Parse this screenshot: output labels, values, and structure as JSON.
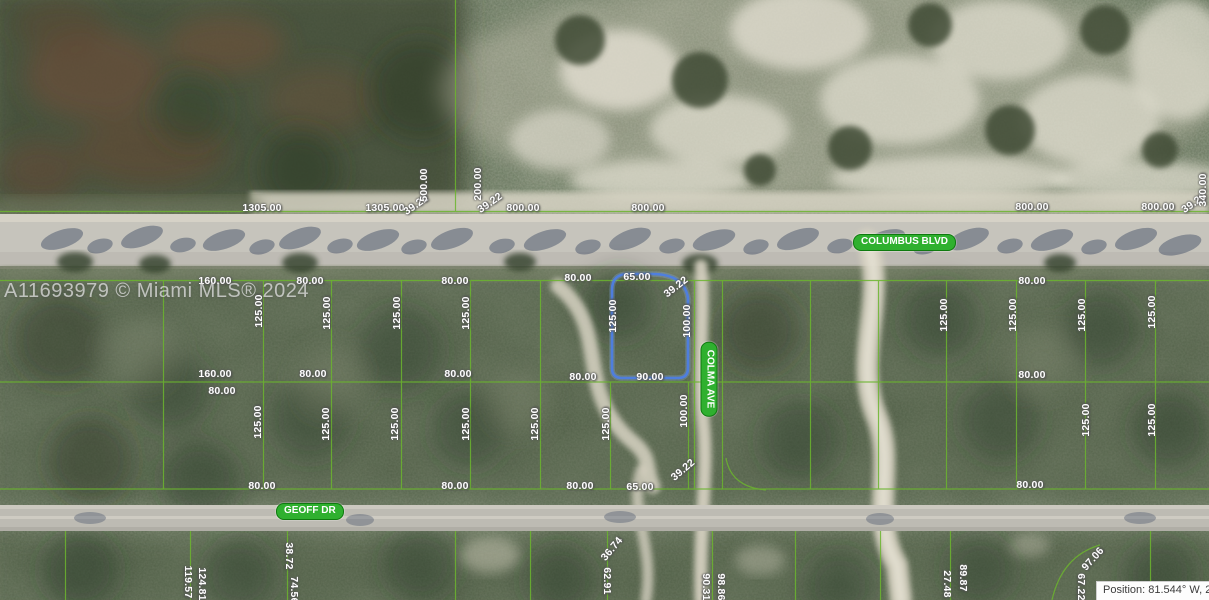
{
  "watermark": {
    "text": "A11693979 © Miami MLS® 2024"
  },
  "status_bar": {
    "position_text": "Position: 81.544° W, 2"
  },
  "streets": {
    "columbus": "COLUMBUS BLVD",
    "geoff": "GEOFF DR",
    "colma": "COLMA AVE"
  },
  "highlighted_parcel": {
    "outline_color": "#4d7ee3",
    "top": "65.00",
    "corner": "39.22",
    "left": "125.00",
    "right": "100.00",
    "bottom": "90.00"
  },
  "colors": {
    "parcel_line_green": "#6cb52e",
    "street_pill_green": "#2fb02f",
    "highlight_blue": "#4d7ee3",
    "road_gray": "#c6c4bc"
  },
  "dimension_labels": [
    {
      "t": "1305.00",
      "x": 262,
      "y": 208,
      "r": 0
    },
    {
      "t": "1305.00",
      "x": 385,
      "y": 208,
      "r": 0
    },
    {
      "t": "39.22",
      "x": 416,
      "y": 205,
      "r": -35
    },
    {
      "t": "500.00",
      "x": 424,
      "y": 185,
      "r": -90
    },
    {
      "t": "200.00",
      "x": 478,
      "y": 184,
      "r": -90
    },
    {
      "t": "39.22",
      "x": 490,
      "y": 203,
      "r": -35
    },
    {
      "t": "800.00",
      "x": 523,
      "y": 208,
      "r": 0
    },
    {
      "t": "800.00",
      "x": 648,
      "y": 208,
      "r": 0
    },
    {
      "t": "800.00",
      "x": 1032,
      "y": 207,
      "r": 0
    },
    {
      "t": "800.00",
      "x": 1158,
      "y": 207,
      "r": 0
    },
    {
      "t": "39.22",
      "x": 1194,
      "y": 203,
      "r": -35
    },
    {
      "t": "340.00",
      "x": 1203,
      "y": 190,
      "r": -90
    },
    {
      "t": "160.00",
      "x": 215,
      "y": 281,
      "r": 0
    },
    {
      "t": "80.00",
      "x": 310,
      "y": 281,
      "r": 0
    },
    {
      "t": "80.00",
      "x": 455,
      "y": 281,
      "r": 0
    },
    {
      "t": "80.00",
      "x": 578,
      "y": 278,
      "r": 0
    },
    {
      "t": "80.00",
      "x": 1032,
      "y": 281,
      "r": 0
    },
    {
      "t": "125.00",
      "x": 259,
      "y": 311,
      "r": -90
    },
    {
      "t": "125.00",
      "x": 327,
      "y": 313,
      "r": -90
    },
    {
      "t": "125.00",
      "x": 397,
      "y": 313,
      "r": -90
    },
    {
      "t": "125.00",
      "x": 466,
      "y": 313,
      "r": -90
    },
    {
      "t": "125.00",
      "x": 944,
      "y": 315,
      "r": -90
    },
    {
      "t": "125.00",
      "x": 1013,
      "y": 315,
      "r": -90
    },
    {
      "t": "125.00",
      "x": 1082,
      "y": 315,
      "r": -90
    },
    {
      "t": "125.00",
      "x": 1152,
      "y": 312,
      "r": -90
    },
    {
      "t": "160.00",
      "x": 215,
      "y": 374,
      "r": 0
    },
    {
      "t": "80.00",
      "x": 222,
      "y": 391,
      "r": 0
    },
    {
      "t": "80.00",
      "x": 313,
      "y": 374,
      "r": 0
    },
    {
      "t": "80.00",
      "x": 458,
      "y": 374,
      "r": 0
    },
    {
      "t": "80.00",
      "x": 583,
      "y": 377,
      "r": 0
    },
    {
      "t": "80.00",
      "x": 1032,
      "y": 375,
      "r": 0
    },
    {
      "t": "125.00",
      "x": 258,
      "y": 422,
      "r": -90
    },
    {
      "t": "125.00",
      "x": 326,
      "y": 424,
      "r": -90
    },
    {
      "t": "125.00",
      "x": 395,
      "y": 424,
      "r": -90
    },
    {
      "t": "125.00",
      "x": 466,
      "y": 424,
      "r": -90
    },
    {
      "t": "125.00",
      "x": 535,
      "y": 424,
      "r": -90
    },
    {
      "t": "125.00",
      "x": 606,
      "y": 424,
      "r": -90
    },
    {
      "t": "100.00",
      "x": 684,
      "y": 411,
      "r": -90
    },
    {
      "t": "125.00",
      "x": 1086,
      "y": 420,
      "r": -90
    },
    {
      "t": "125.00",
      "x": 1152,
      "y": 420,
      "r": -90
    },
    {
      "t": "80.00",
      "x": 262,
      "y": 486,
      "r": 0
    },
    {
      "t": "80.00",
      "x": 455,
      "y": 486,
      "r": 0
    },
    {
      "t": "80.00",
      "x": 580,
      "y": 486,
      "r": 0
    },
    {
      "t": "65.00",
      "x": 640,
      "y": 487,
      "r": 0
    },
    {
      "t": "39.22",
      "x": 683,
      "y": 470,
      "r": -40
    },
    {
      "t": "80.00",
      "x": 1030,
      "y": 485,
      "r": 0
    },
    {
      "t": "119.57",
      "x": 188,
      "y": 582,
      "r": 90
    },
    {
      "t": "124.81",
      "x": 202,
      "y": 584,
      "r": 90
    },
    {
      "t": "38.72",
      "x": 289,
      "y": 556,
      "r": 90
    },
    {
      "t": "74.56",
      "x": 294,
      "y": 590,
      "r": 90
    },
    {
      "t": "36.74",
      "x": 612,
      "y": 549,
      "r": -50
    },
    {
      "t": "62.91",
      "x": 607,
      "y": 581,
      "r": 90
    },
    {
      "t": "90.31",
      "x": 706,
      "y": 587,
      "r": 90
    },
    {
      "t": "98.86",
      "x": 721,
      "y": 587,
      "r": 90
    },
    {
      "t": "27.48",
      "x": 947,
      "y": 584,
      "r": 90
    },
    {
      "t": "89.87",
      "x": 963,
      "y": 578,
      "r": 90
    },
    {
      "t": "67.22",
      "x": 1081,
      "y": 587,
      "r": 90
    },
    {
      "t": "97.06",
      "x": 1093,
      "y": 559,
      "r": -48
    }
  ]
}
